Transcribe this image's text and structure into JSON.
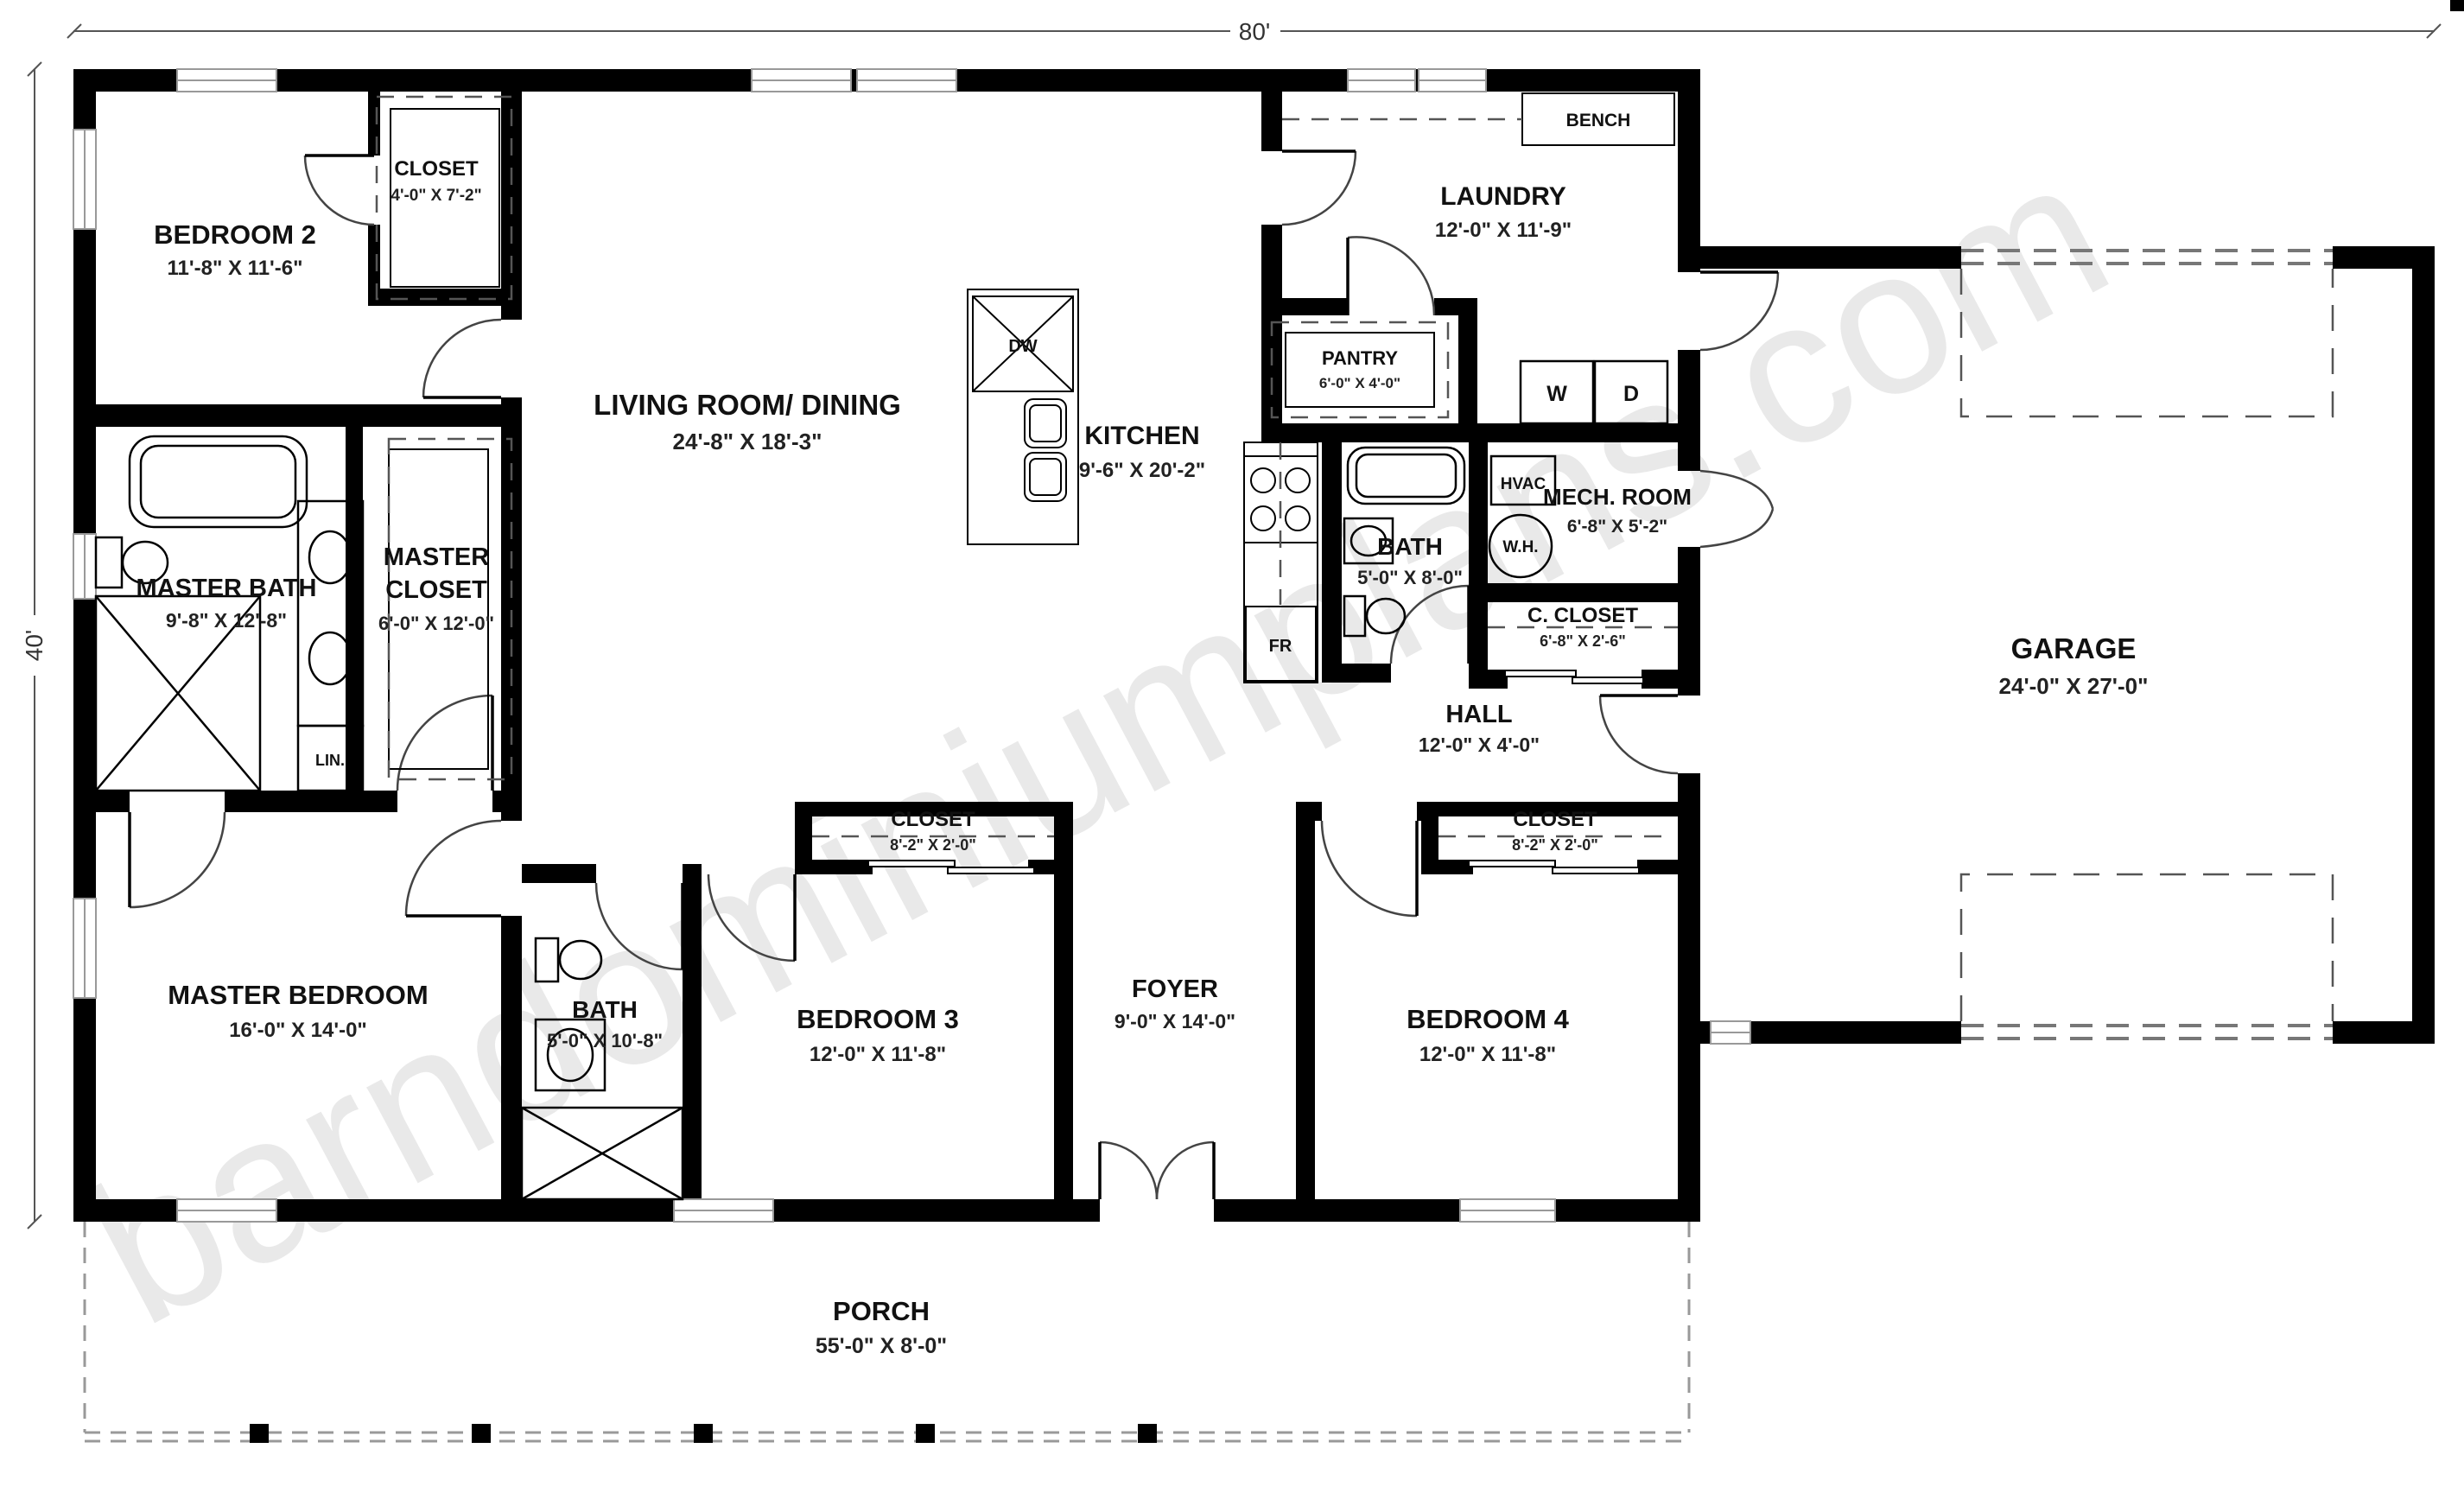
{
  "watermark": "barndominiumplans.com",
  "dimensions": {
    "width_overall": "80'",
    "height_overall": "40'"
  },
  "rooms": {
    "bedroom2": {
      "name": "BEDROOM 2",
      "dims": "11'-8\" X 11'-6\""
    },
    "bedroom2_closet": {
      "name": "CLOSET",
      "dims": "4'-0\" X 7'-2\""
    },
    "living": {
      "name": "LIVING ROOM/ DINING",
      "dims": "24'-8\" X 18'-3\""
    },
    "kitchen": {
      "name": "KITCHEN",
      "dims": "9'-6\" X 20'-2\""
    },
    "laundry": {
      "name": "LAUNDRY",
      "dims": "12'-0\" X 11'-9\""
    },
    "pantry": {
      "name": "PANTRY",
      "dims": "6'-0\" X 4'-0\""
    },
    "master_bath": {
      "name": "MASTER BATH",
      "dims": "9'-8\" X 12'-8\""
    },
    "master_closet": {
      "name_line1": "MASTER",
      "name_line2": "CLOSET",
      "dims": "6'-0\" X 12'-0\""
    },
    "bath_upper": {
      "name": "BATH",
      "dims": "5'-0\" X 8'-0\""
    },
    "mech_room": {
      "name": "MECH. ROOM",
      "dims": "6'-8\" X 5'-2\""
    },
    "c_closet": {
      "name": "C. CLOSET",
      "dims": "6'-8\" X 2'-6\""
    },
    "hall": {
      "name": "HALL",
      "dims": "12'-0\" X 4'-0\""
    },
    "garage": {
      "name": "GARAGE",
      "dims": "24'-0\" X 27'-0\""
    },
    "master_bedroom": {
      "name": "MASTER BEDROOM",
      "dims": "16'-0\" X 14'-0\""
    },
    "bath_hall": {
      "name": "BATH",
      "dims": "5'-0\" X 10'-8\""
    },
    "bedroom3": {
      "name": "BEDROOM 3",
      "dims": "12'-0\" X 11'-8\""
    },
    "bedroom3_closet": {
      "name": "CLOSET",
      "dims": "8'-2\" X 2'-0\""
    },
    "foyer": {
      "name": "FOYER",
      "dims": "9'-0\" X 14'-0\""
    },
    "bedroom4": {
      "name": "BEDROOM 4",
      "dims": "12'-0\" X 11'-8\""
    },
    "bedroom4_closet": {
      "name": "CLOSET",
      "dims": "8'-2\" X 2'-0\""
    },
    "porch": {
      "name": "PORCH",
      "dims": "55'-0\" X 8'-0\""
    }
  },
  "fixtures": {
    "bench": "BENCH",
    "washer": "W",
    "dryer": "D",
    "dishwasher": "DW",
    "fridge": "FR",
    "hvac": "HVAC",
    "water_heater": "W.H.",
    "linen": "LIN."
  },
  "colors": {
    "wall": "#000000",
    "watermark": "#e0e0e0",
    "background": "#ffffff",
    "dimension_text": "#333333"
  }
}
